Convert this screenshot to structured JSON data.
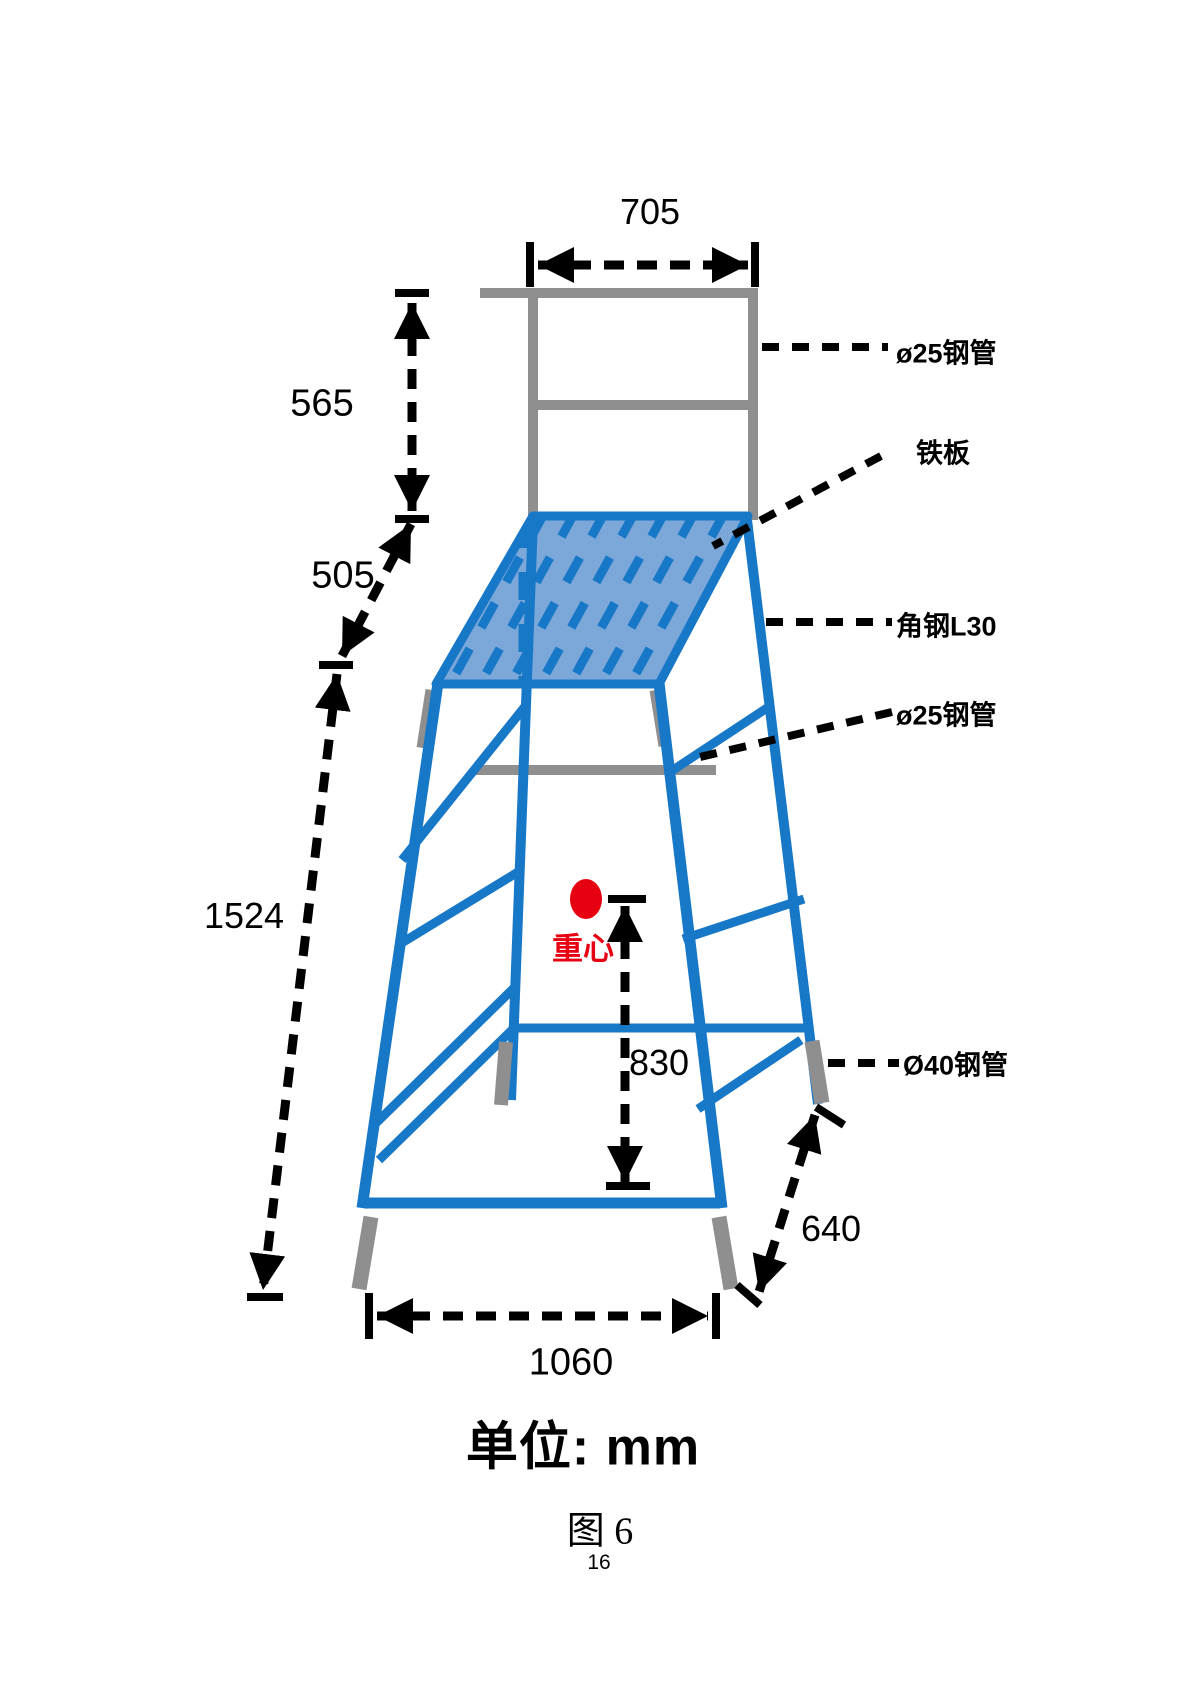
{
  "dims": {
    "top_width": "705",
    "backrest_height": "565",
    "platform_depth": "505",
    "overall_height": "1524",
    "cog_height": "830",
    "base_depth": "640",
    "base_width": "1060"
  },
  "labels": {
    "pipe25_top": "ø25钢管",
    "iron_plate": "铁板",
    "angle_steel_l30": "角钢L30",
    "pipe25_mid": "ø25钢管",
    "pipe40": "Ø40钢管",
    "center_of_gravity": "重心"
  },
  "footer": {
    "unit_note": "单位: mm",
    "figure_caption": "图 6",
    "page_number": "16"
  },
  "colors": {
    "frame_blue": "#1878c8",
    "plate_fill_blue": "#7ca7d9",
    "steel_gray": "#8f8f8f",
    "cog_red": "#e60012",
    "line_black": "#000000"
  }
}
